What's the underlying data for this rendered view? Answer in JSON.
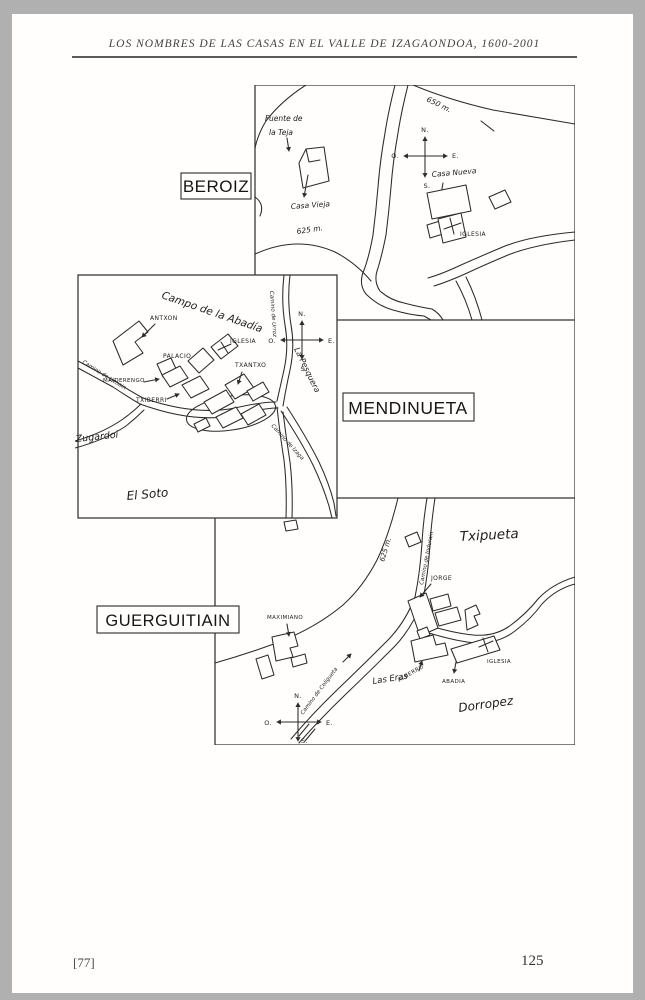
{
  "page": {
    "header": "LOS NOMBRES DE LAS CASAS EN EL VALLE DE IZAGAONDOA, 1600-2001",
    "footer_left": "[77]",
    "page_number": "125"
  },
  "colors": {
    "ink": "#2b2b2b",
    "paper": "#fffefc",
    "scan_background": "#b0b0b0"
  },
  "compass": {
    "n": "N.",
    "e": "E.",
    "s": "S.",
    "o": "O."
  },
  "maps": {
    "beroiz": {
      "title": "BEROIZ",
      "labels": {
        "contour_650": "650 m.",
        "contour_625": "625 m.",
        "fuente_line1": "Fuente de",
        "fuente_line2": "la Teja",
        "casa_vieja": "Casa Vieja",
        "casa_nueva": "Casa Nueva",
        "iglesia": "IGLESIA"
      }
    },
    "mendinueta": {
      "title": "MENDINUETA",
      "labels": {
        "campo_abadia": "Campo de la Abadía",
        "antxon": "ANTXON",
        "iglesia": "IGLESIA",
        "palacio": "PALACIO",
        "txantxo": "TXANTXO",
        "maiderengo": "MAIDERENGO",
        "txiberri": "TXIBERRI",
        "camino_lizoain": "Camino de Lizoain",
        "camino_urroz": "Camino de Urroz",
        "camino_izaga": "Camino de Izaga",
        "la_pesquera": "La Pesquera",
        "zugardoi": "Zugardoi",
        "el_soto": "El Soto"
      }
    },
    "guerguitiain": {
      "title": "GUERGUITIAIN",
      "labels": {
        "txipueta": "Txipueta",
        "contour_625": "625 m.",
        "camino_indurain": "Camino de Indurain",
        "camino_celigueta": "Camino de Celigueta",
        "jorge": "JORGE",
        "maximiano": "MAXIMIANO",
        "alberro": "ALBERRO",
        "abadia": "ABADIA",
        "iglesia": "IGLESIA",
        "las_eras": "Las Eras",
        "dorropez": "Dorropez"
      }
    }
  }
}
